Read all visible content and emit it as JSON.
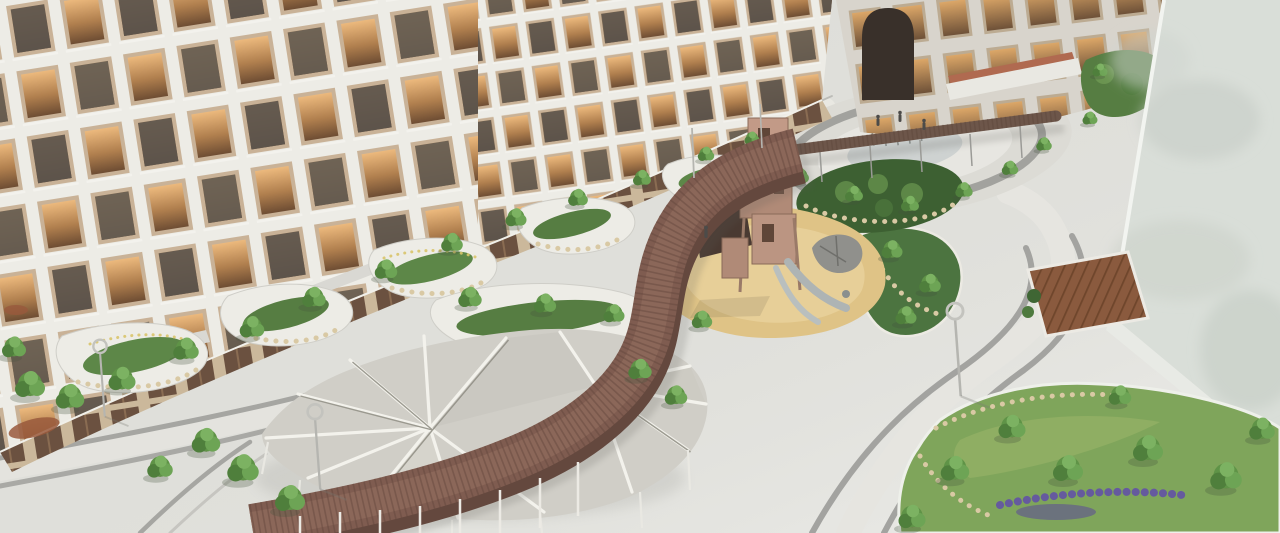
{
  "scene": {
    "title": "Residential courtyard — aerial architectural rendering",
    "type": "3d-architectural-visualization",
    "view": "aerial oblique, dusk lighting with warm lit windows",
    "features": [
      "curved white apartment block with recessed balconies and amber-lit windows",
      "grey wing with tall arched passage",
      "blank light-grey wall of foreground building on the right",
      "serpentine elevated timber walkway descending through the courtyard",
      "white faceted shade canopy with radial slit pattern over seating area",
      "children's playground with timber climbing tower, slides and boulder sculpture",
      "oval plaza with dry fountain jets crossed by a slim timber pergola",
      "curved grey paving bands on light granite plaza floor",
      "organic white-edged planters with trees, shrubs, boulders and lavender",
      "timber deck terraces and ring-head street lamps"
    ]
  },
  "palette": {
    "paving_light": "#dfdfda",
    "paving_band": "#a3a3a0",
    "facade": "#edece6",
    "window_frame": "#c9b297",
    "window_glow": "#d89a5d",
    "glass_dark": "#5b544c",
    "wall": "#d9ded8",
    "canopy": "#d0cec7",
    "walkway": "#7f5c50",
    "pergola": "#6d564a",
    "playground": "#dfc386",
    "lawn": "#7fa55b",
    "shrub_dark": "#3d6032",
    "tree_green": "#5f9347",
    "arch": "#39302a",
    "terracotta": "#b06a50",
    "lavender": "#655a9e",
    "stone": "#d9c9a4",
    "deck": "#8a5a3e"
  }
}
